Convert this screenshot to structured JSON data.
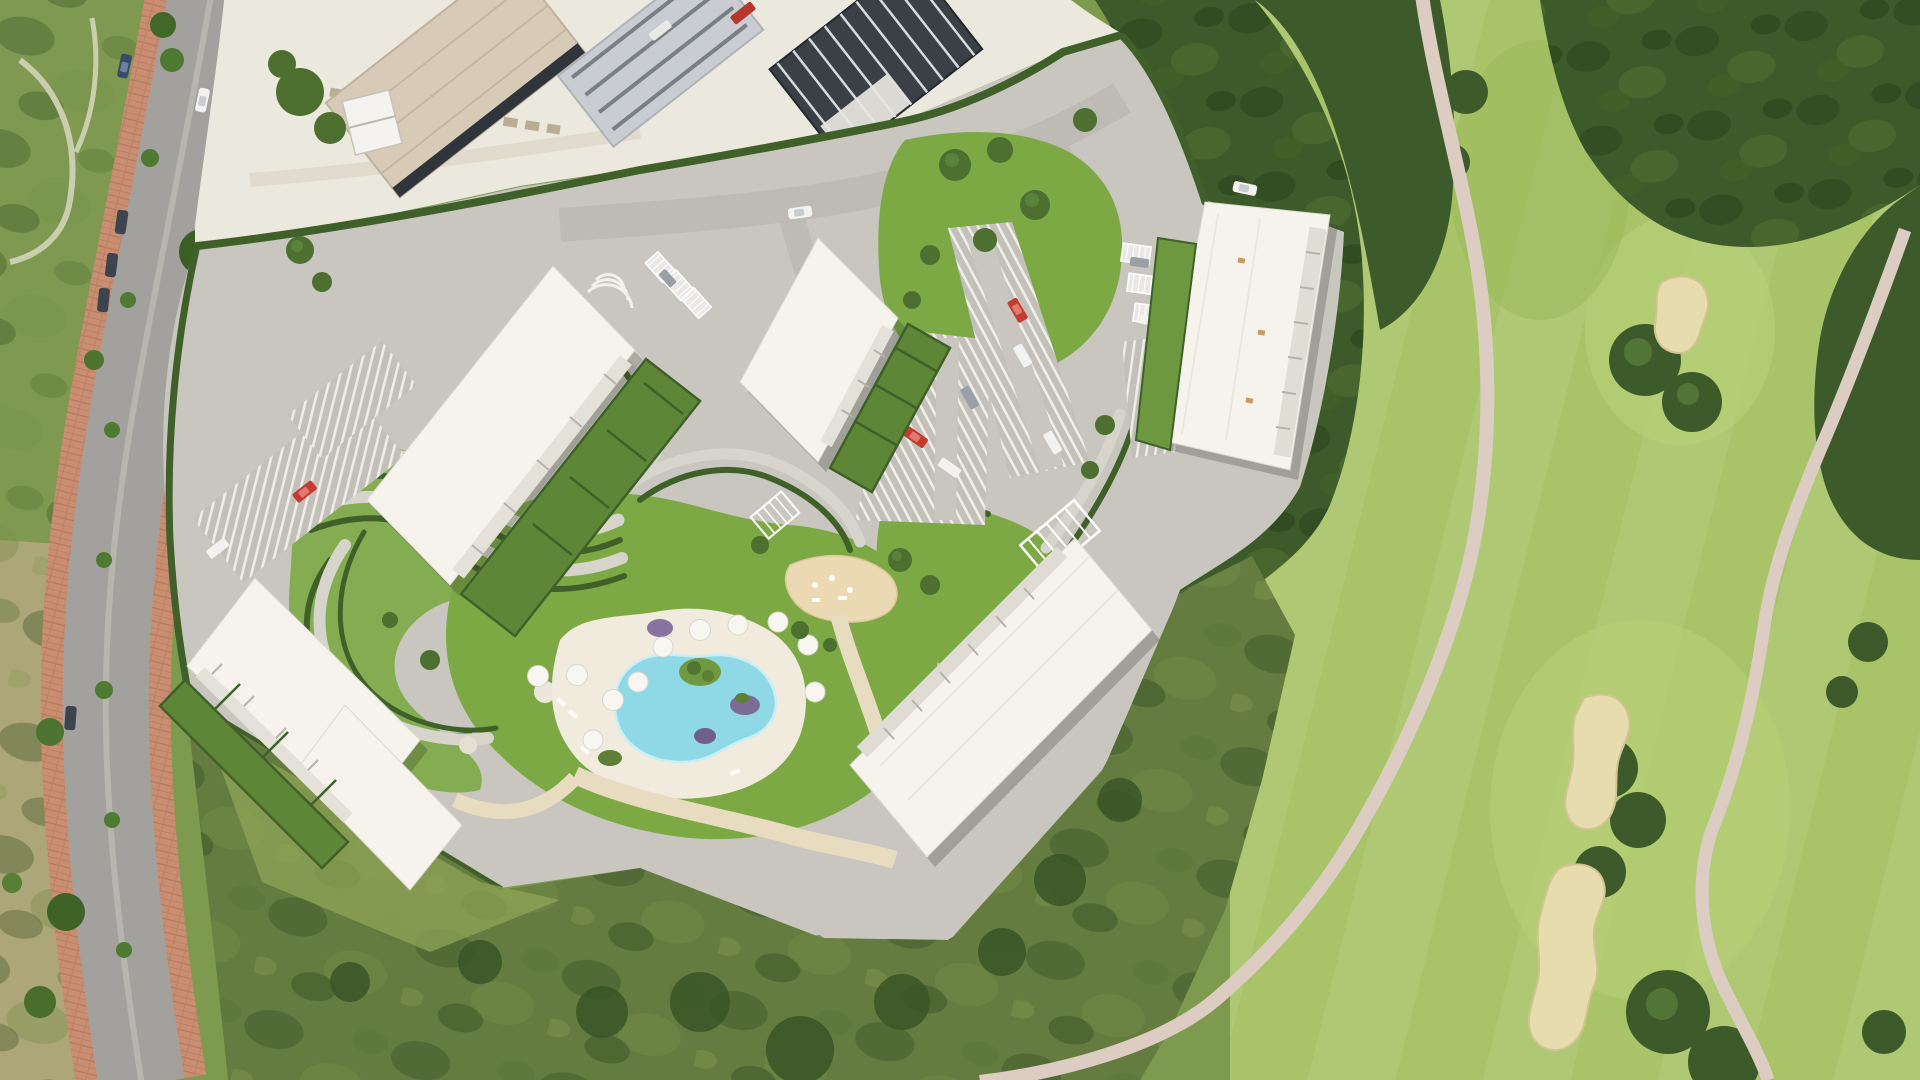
{
  "meta": {
    "scene": "aerial-render-of-residential-development-beside-golf-course",
    "view": "top-down satellite composite with 3D-rendered site plan",
    "visible_text": "none"
  },
  "colors": {
    "base": "#7d9a4f",
    "fairway": "#a9c468",
    "fairway_light": "#b7d077",
    "tree_dark": "#3d5b2a",
    "tree_mid": "#4d7030",
    "tree_light": "#639042",
    "bunker": "#e7dcae",
    "bunker_edge": "#d2c390",
    "cart_path": "#ddccc2",
    "scrub": "#647c40",
    "meadow": "#8da455",
    "dry_scrub": "#b3a77c",
    "road": "#a2a19e",
    "sidewalk": "#c98e72",
    "median": "#b6b6af",
    "construction_dirt": "#ebe8dd",
    "slab": "#d7cbb8",
    "slab_gray": "#c9cdd1",
    "frame_dark": "#3a4046",
    "paving": "#c8c6bf",
    "path_light": "#d8d5cd",
    "sand_path": "#e8dcc0",
    "lawn": "#7ca944",
    "lawn_dark": "#5d8637",
    "hedge": "#3f6129",
    "pool_water": "#8fd9e7",
    "pool_rim": "#c9eef6",
    "deck": "#f0ebdc",
    "sand": "#ead9b2",
    "building": "#f5f3ec",
    "terrace": "#e0ddd4",
    "terrace_tick": "#b5b2a9",
    "shadow": "rgba(45,48,35,0.25)",
    "umbrella": "#f7f6f1",
    "car_red": "#c63a30",
    "car_white": "#f2f2f0",
    "car_gray": "#9aa0a6",
    "car_dark": "#3c4450",
    "car_blue": "#3a4a6b",
    "car_orange": "#d97b2e",
    "flower_purple": "#7c6b95"
  },
  "features": {
    "apartment_buildings": 5,
    "swimming_pool": "kidney-shaped communal pool with island planter",
    "parasols": 11,
    "golf_bunkers": 3,
    "parking_lots": 5,
    "playground": "sand play area",
    "road": "dual carriageway with terracotta sidewalks",
    "construction_zone": "building works at top of site",
    "golf_course": "fairway, tree belts and cart paths on right side"
  }
}
